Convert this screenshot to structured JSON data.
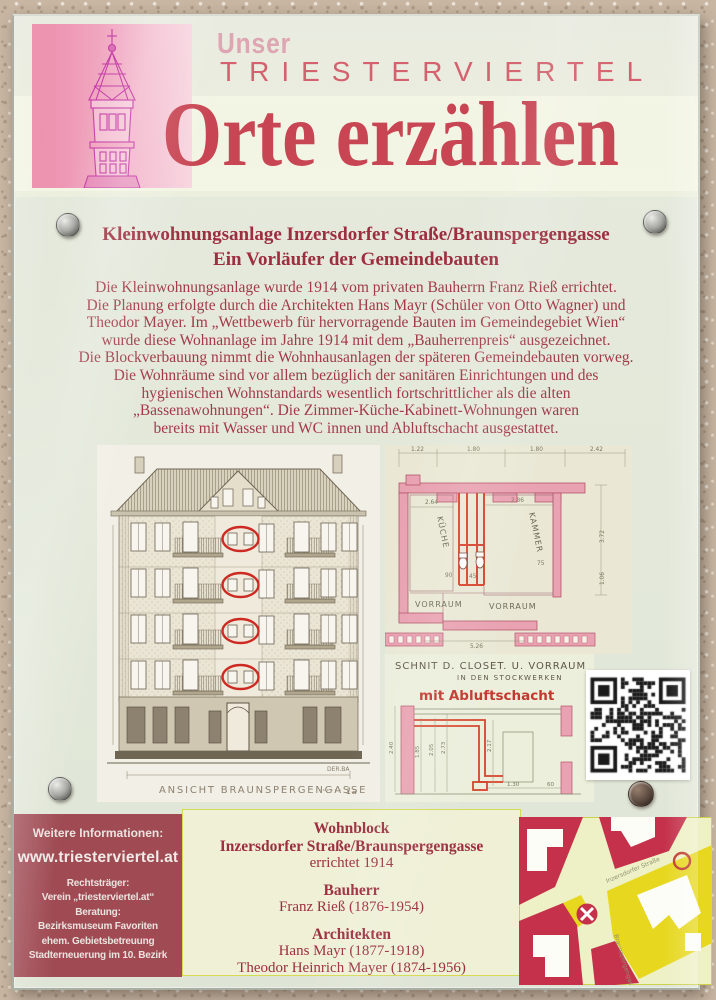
{
  "header": {
    "pretitle": "Unser",
    "brand": "TRIESTERVIERTEL",
    "title": "Orte erzählen"
  },
  "heading": {
    "line1": "Kleinwohnungsanlage Inzersdorfer Straße/Braunspergengasse",
    "line2": "Ein Vorläufer der Gemeindebauten"
  },
  "body_lines": [
    "Die Kleinwohnungsanlage wurde 1914 vom privaten Bauherrn Franz Rieß errichtet.",
    "Die Planung erfolgte durch die Architekten Hans Mayr (Schüler von Otto Wagner) und",
    "Theodor Mayer. Im „Wettbewerb für hervorragende Bauten im Gemeindegebiet Wien“",
    "wurde diese Wohnanlage im Jahre 1914 mit dem „Bauherrenpreis“ ausgezeichnet.",
    "Die Blockverbauung nimmt die Wohnhausanlagen der späteren Gemeindebauten vorweg.",
    "Die Wohnräume sind vor allem bezüglich der sanitären Einrichtungen und des",
    "hygienischen Wohnstandards wesentlich fortschrittlicher als die alten",
    "„Bassenawohnungen“. Die Zimmer-Küche-Kabinett-Wohnungen waren",
    "bereits mit Wasser und WC innen und Abluftschacht ausgestattet."
  ],
  "facade": {
    "caption": "ANSICHT BRAUNSPERGENGASSE",
    "scale_note": "1a",
    "corner_note": "DER.BA"
  },
  "floorplan": {
    "room_labels": [
      "KÜCHE",
      "KAMMER",
      "VORRAUM",
      "VORRAUM"
    ],
    "dims": [
      "1.22",
      "1.80",
      "1.80",
      "2.42",
      "2.64",
      "2.86",
      "3.72",
      "90",
      "45",
      "75",
      "5.26",
      "1.06"
    ]
  },
  "section_drawing": {
    "title": "SCHNIT D. CLOSET. U. VORRAUM",
    "subtitle": "IN DEN STOCKWERKEN",
    "highlight": "mit Abluftschacht",
    "dims": [
      "2.40",
      "1.85",
      "2.05",
      "2.73",
      "2.17",
      "1.30",
      "60"
    ]
  },
  "info_box": {
    "label": "Weitere Informationen:",
    "url": "www.triesterviertel.at",
    "lines": [
      "Rechtsträger:",
      "Verein „triesterviertel.at“",
      "Beratung:",
      "Bezirksmuseum Favoriten",
      "ehem. Gebietsbetreuung",
      "Stadterneuerung im 10. Bezirk"
    ]
  },
  "details": {
    "group1_title": "Wohnblock",
    "group1_line1": "Inzersdorfer Straße/Braunspergengasse",
    "group1_line2": "errichtet 1914",
    "group2_title": "Bauherr",
    "group2_line1": "Franz Rieß (1876-1954)",
    "group3_title": "Architekten",
    "group3_line1": "Hans Mayr (1877-1918)",
    "group3_line2": "Theodor Heinrich Mayer (1874-1956)"
  },
  "map": {
    "street1": "Inzersdorfer Straße",
    "street2": "Braunspergengasse"
  },
  "colors": {
    "brand_red": "#c84553",
    "heading_red": "#9c2e3f",
    "body_red": "#a23a48",
    "info_box_bg": "#a04b54",
    "map_red": "#c5314b",
    "map_yellow": "#e7d81f",
    "shaft_highlight_red": "#d8432c",
    "tower_magenta": "#c438a5"
  }
}
